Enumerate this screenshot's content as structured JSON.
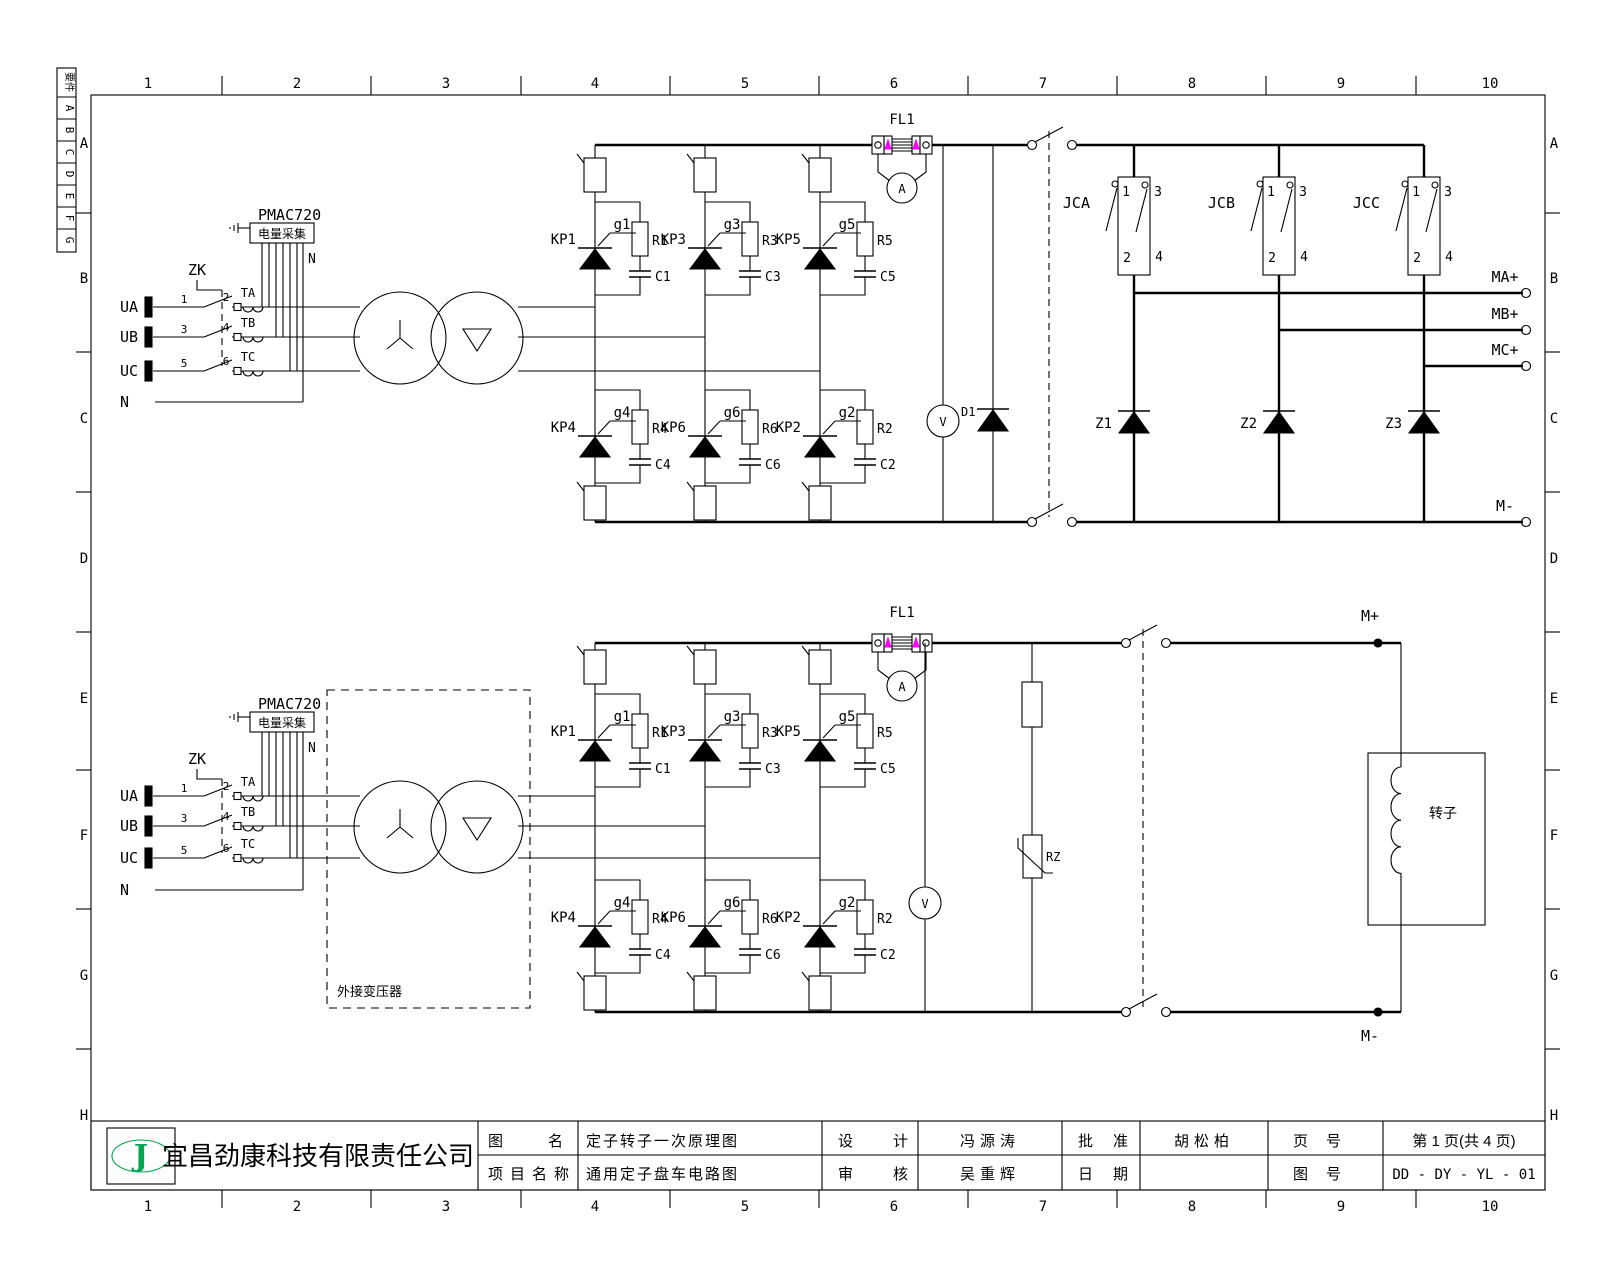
{
  "frame": {
    "cols": [
      "1",
      "2",
      "3",
      "4",
      "5",
      "6",
      "7",
      "8",
      "9",
      "10"
    ],
    "rows": [
      "A",
      "B",
      "C",
      "D",
      "E",
      "F",
      "G",
      "H"
    ],
    "rev_header": "要件",
    "rev_cells": [
      "A",
      "B",
      "C",
      "D",
      "E",
      "F",
      "G"
    ]
  },
  "c1": {
    "ua": "UA",
    "ub": "UB",
    "uc": "UC",
    "n": "N",
    "zk": "ZK",
    "k1": "1",
    "k2": "2",
    "k3": "3",
    "k4": "4",
    "k5": "5",
    "k6": "6",
    "ta": "TA",
    "tb": "TB",
    "tc": "TC",
    "pmac": "PMAC720",
    "pmac_box": "电量采集",
    "pmac_n": "N",
    "fl": "FL1",
    "am": "A",
    "vm": "V",
    "d": "D1",
    "cells": {
      "kp1": "KP1",
      "g1": "g1",
      "r1": "R1",
      "c1": "C1",
      "kp3": "KP3",
      "g3": "g3",
      "r3": "R3",
      "c3": "C3",
      "kp5": "KP5",
      "g5": "g5",
      "r5": "R5",
      "c5": "C5",
      "kp4": "KP4",
      "g4": "g4",
      "r4": "R4",
      "c4": "C4",
      "kp6": "KP6",
      "g6": "g6",
      "r6": "R6",
      "c6": "C6",
      "kp2": "KP2",
      "g2": "g2",
      "r2": "R2",
      "c2": "C2"
    },
    "jca": "JCA",
    "jcb": "JCB",
    "jcc": "JCC",
    "p1": "1",
    "p2": "2",
    "p3": "3",
    "p4": "4",
    "z1": "Z1",
    "z2": "Z2",
    "z3": "Z3",
    "ma": "MA+",
    "mb": "MB+",
    "mc": "MC+",
    "mn": "M-"
  },
  "c2": {
    "ua": "UA",
    "ub": "UB",
    "uc": "UC",
    "n": "N",
    "zk": "ZK",
    "k1": "1",
    "k2": "2",
    "k3": "3",
    "k4": "4",
    "k5": "5",
    "k6": "6",
    "ta": "TA",
    "tb": "TB",
    "tc": "TC",
    "pmac": "PMAC720",
    "pmac_box": "电量采集",
    "pmac_n": "N",
    "fl": "FL1",
    "am": "A",
    "vm": "V",
    "rz": "RZ",
    "ext": "外接变压器",
    "rotor": "转子",
    "cells": {
      "kp1": "KP1",
      "g1": "g1",
      "r1": "R1",
      "c1": "C1",
      "kp3": "KP3",
      "g3": "g3",
      "r3": "R3",
      "c3": "C3",
      "kp5": "KP5",
      "g5": "g5",
      "r5": "R5",
      "c5": "C5",
      "kp4": "KP4",
      "g4": "g4",
      "r4": "R4",
      "c4": "C4",
      "kp6": "KP6",
      "g6": "g6",
      "r6": "R6",
      "c6": "C6",
      "kp2": "KP2",
      "g2": "g2",
      "r2": "R2",
      "c2": "C2"
    },
    "mp": "M+",
    "mn": "M-"
  },
  "tb": {
    "company": "宜昌劲康科技有限责任公司",
    "logo": "J",
    "name_label": "图名",
    "name_value": "定子转子一次原理图",
    "proj_label": "项目名称",
    "proj_value": "通用定子盘车电路图",
    "design_label": "设计",
    "designer": "冯源涛",
    "check_label": "审核",
    "checker": "吴重辉",
    "approve_label": "批准",
    "approver": "胡松柏",
    "date_label": "日期",
    "date_value": "",
    "page_label": "页号",
    "page_value": "第 1 页(共 4 页)",
    "dwg_label": "图号",
    "dwg_value": "DD - DY - YL - 01"
  },
  "colors": {
    "accent_magenta": "#ff00ff",
    "logo_green": "#00a550"
  }
}
